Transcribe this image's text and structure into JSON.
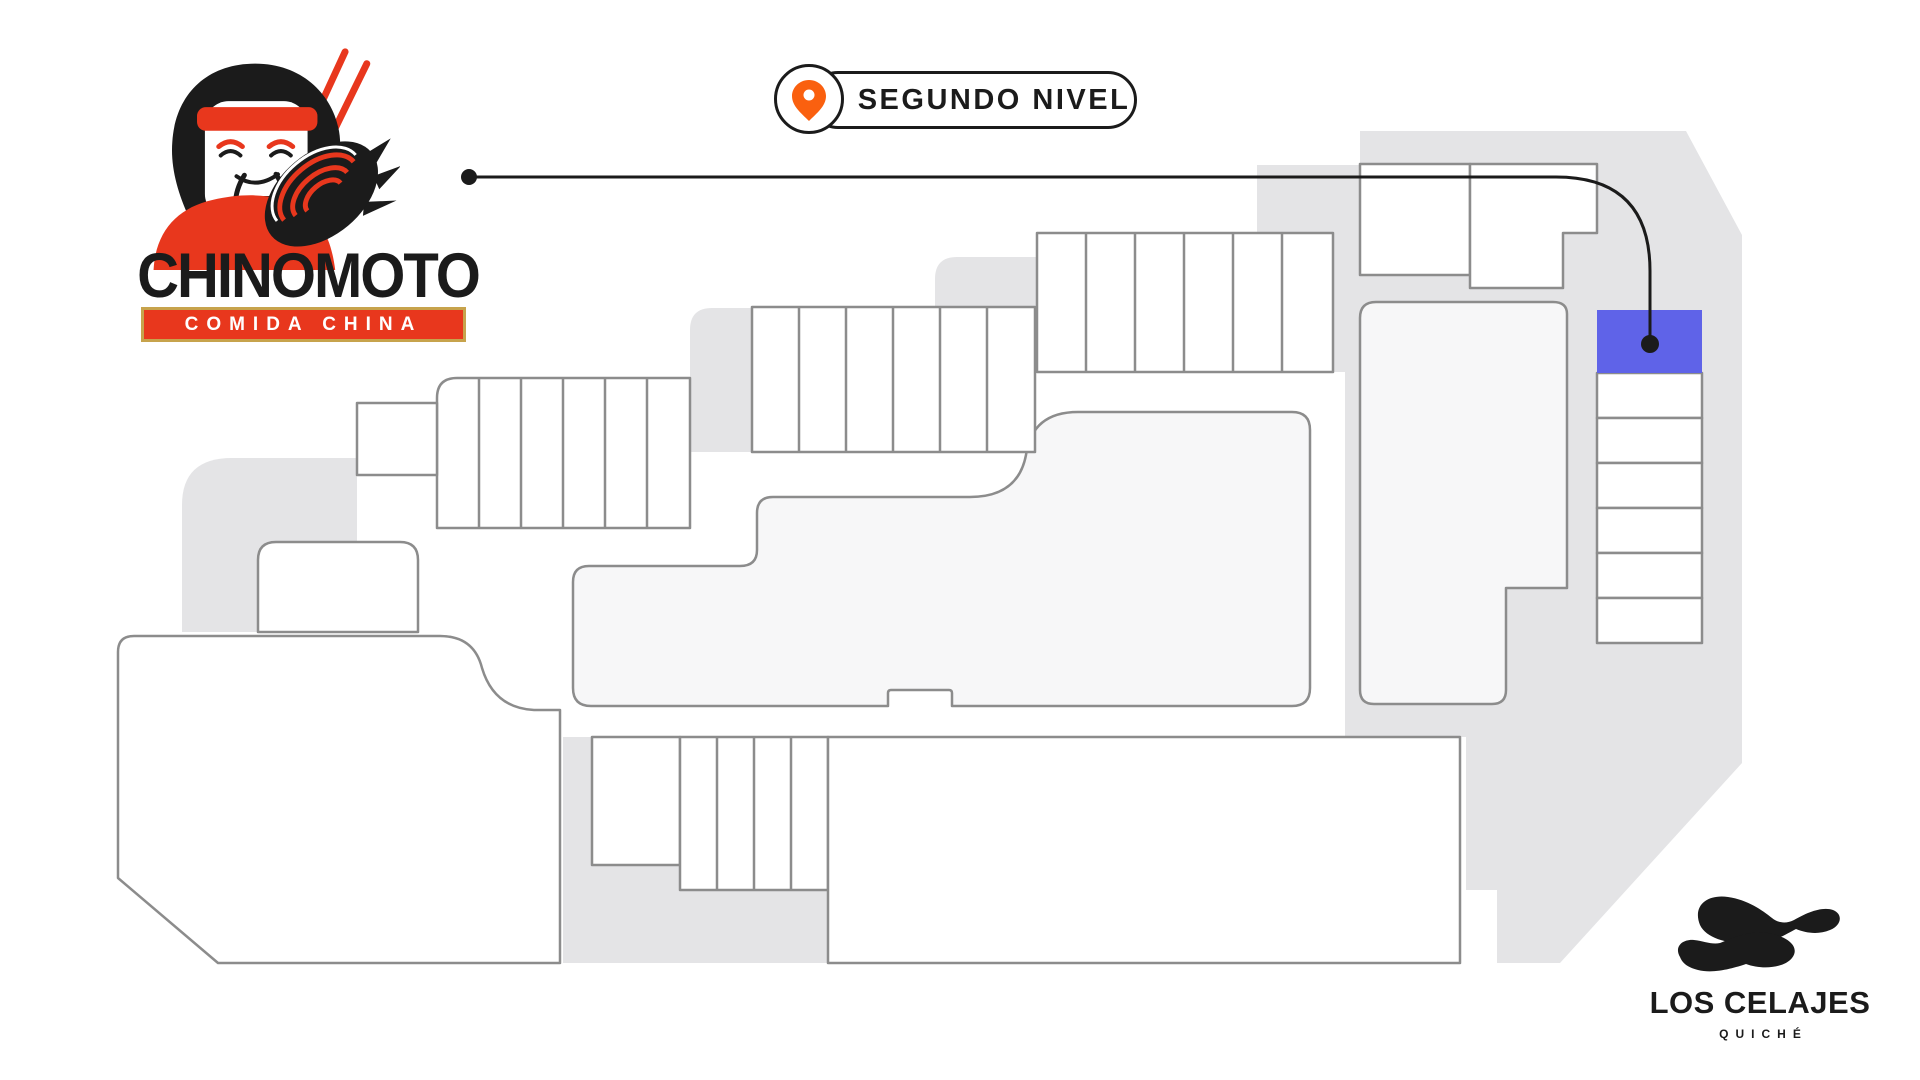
{
  "badge": {
    "label": "SEGUNDO NIVEL"
  },
  "brand": {
    "name": "CHINOMOTO",
    "tagline": "COMIDA CHINA",
    "colors": {
      "red": "#E8371D",
      "gold": "#C7A34C",
      "black": "#1B1B1B"
    }
  },
  "mall": {
    "name": "LOS CELAJES",
    "subtitle": "QUICHÉ"
  },
  "map": {
    "highlight_color": "#5F63E8",
    "pin_color": "#FA600F",
    "silhouette_color": "#E4E4E6",
    "unit_fill": "#FFFFFF",
    "anchor_fill": "#F7F7F8",
    "unit_stroke": "#8C8C8C",
    "connector_color": "#1B1B1B"
  }
}
